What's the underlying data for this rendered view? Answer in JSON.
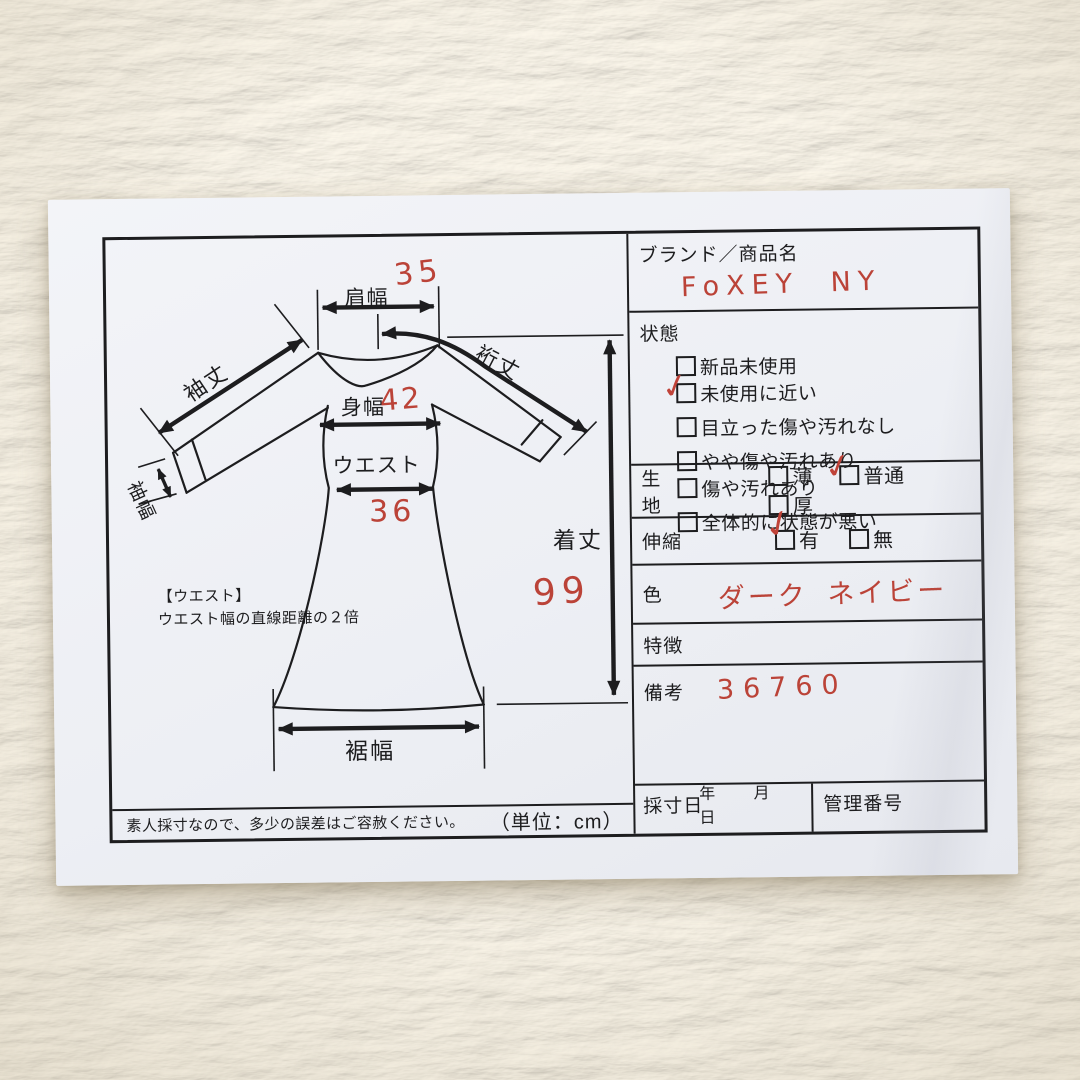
{
  "marks": {
    "check": "✓"
  },
  "colors": {
    "paper": "#edeff4",
    "ink": "#1d1d1f",
    "handwriting_red": "#bb4338"
  },
  "diagram": {
    "shoulder_label": "肩幅",
    "shoulder_value": "35",
    "yuki_label": "裄丈",
    "sleeve_length_label": "袖丈",
    "sleeve_width_label": "袖幅",
    "body_width_label": "身幅",
    "body_width_value": "42",
    "waist_label": "ウエスト",
    "waist_value": "36",
    "length_label": "着丈",
    "length_value": "99",
    "hem_label": "裾幅",
    "waist_note_title": "【ウエスト】",
    "waist_note_body": "ウエスト幅の直線距離の２倍",
    "disclaimer": "素人採寸なので、多少の誤差はご容赦ください。",
    "unit_note": "（単位：cm）"
  },
  "form": {
    "brand": {
      "label": "ブランド／商品名",
      "value": "FoXEY NY"
    },
    "condition": {
      "label": "状態",
      "options": [
        {
          "label": "新品未使用",
          "checked": false
        },
        {
          "label": "未使用に近い",
          "checked": true
        },
        {
          "label": "目立った傷や汚れなし",
          "checked": false
        },
        {
          "label": "やや傷や汚れあり",
          "checked": false
        },
        {
          "label": "傷や汚れあり",
          "checked": false
        },
        {
          "label": "全体的に状態が悪い",
          "checked": false
        }
      ]
    },
    "fabric": {
      "label": "生地",
      "options": [
        {
          "label": "薄",
          "checked": false
        },
        {
          "label": "普通",
          "checked": true
        },
        {
          "label": "厚",
          "checked": false
        }
      ]
    },
    "stretch": {
      "label": "伸縮",
      "options": [
        {
          "label": "有",
          "checked": true
        },
        {
          "label": "無",
          "checked": false
        }
      ]
    },
    "color": {
      "label": "色",
      "value": "ダーク ネイビー"
    },
    "features": {
      "label": "特徴",
      "value": ""
    },
    "remarks": {
      "label": "備考",
      "value": "36760"
    },
    "measure_date": {
      "label": "採寸日",
      "units": [
        "年",
        "月",
        "日"
      ]
    },
    "control_number": {
      "label": "管理番号"
    }
  }
}
